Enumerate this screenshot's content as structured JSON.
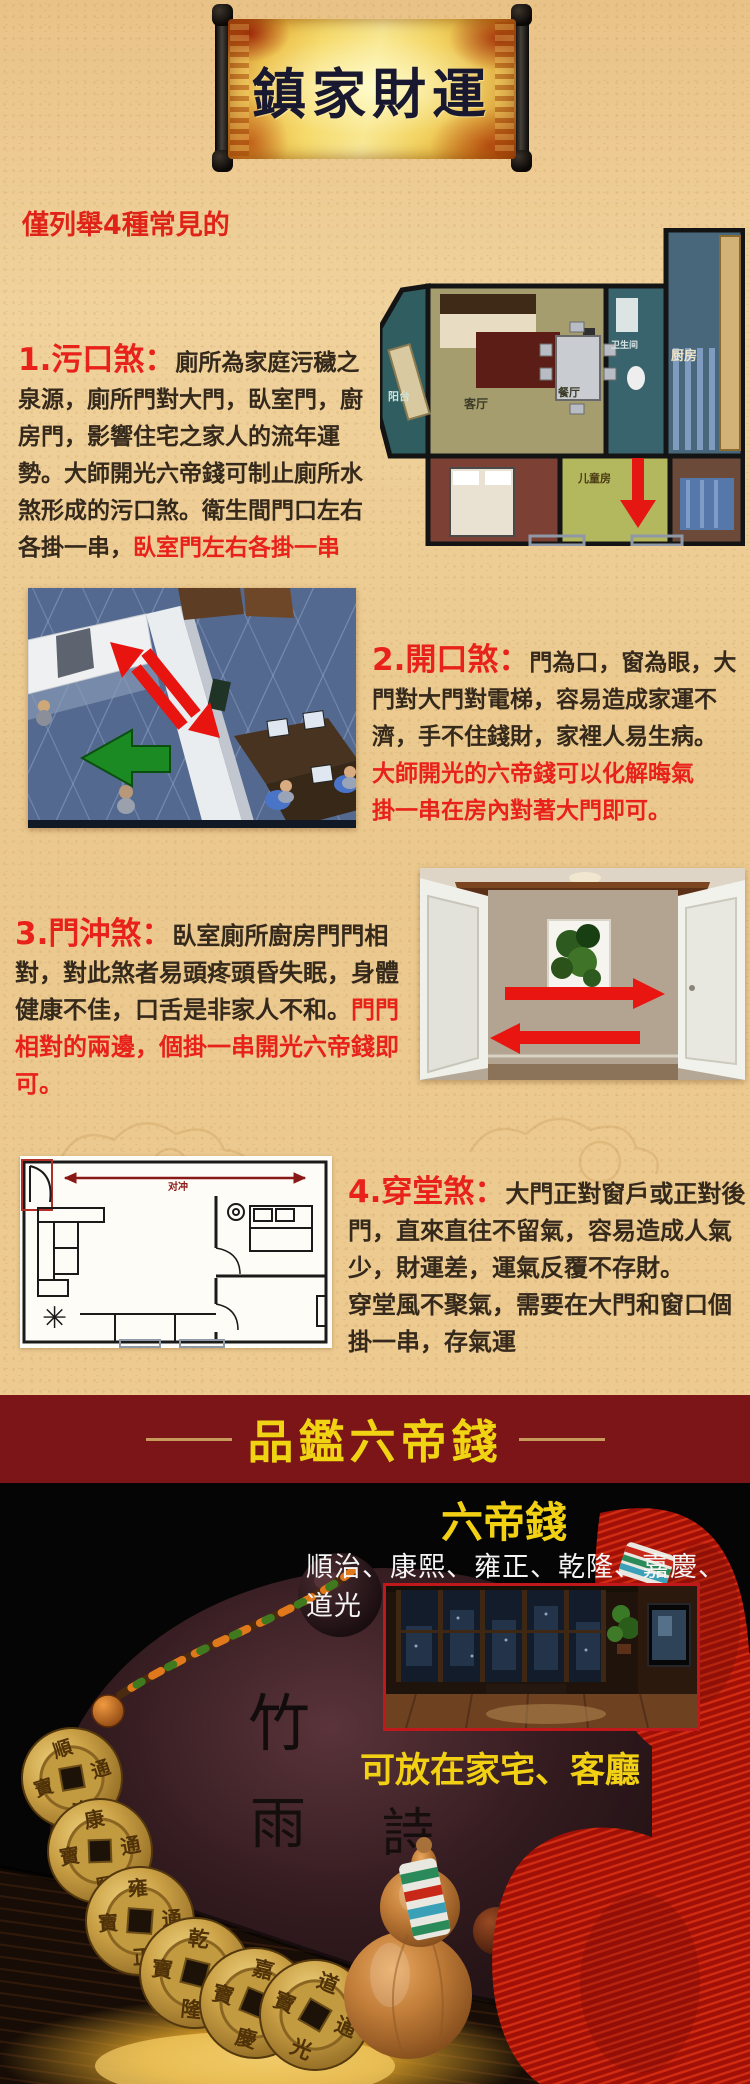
{
  "banner": {
    "title": "鎮家財運"
  },
  "intro": {
    "text": "僅列舉4種常見的"
  },
  "sections": [
    {
      "heading": "1.污口煞：",
      "body": "廁所為家庭污穢之泉源，廁所門對大門，臥室門，廚房門，影響住宅之家人的流年運勢。大師開光六帝錢可制止廁所水煞形成的污口煞。衛生間門口左右各掛一串，",
      "highlight": "臥室門左右各掛一串"
    },
    {
      "heading": "2.開口煞：",
      "body": "門為口，窗為眼，大門對大門對電梯，容易造成家運不濟，手不住錢財，家裡人易生病。",
      "highlight1": "大師開光的六帝錢可以化解晦氣",
      "highlight2": "掛一串在房內對著大門即可。"
    },
    {
      "heading": "3.門沖煞：",
      "body": "臥室廁所廚房門門相對，對此煞者易頭疼頭昏失眠，身體健康不佳，口舌是非家人不和。",
      "highlight": "門門相對的兩邊，個掛一串開光六帝錢即可。"
    },
    {
      "heading": "4.穿堂煞：",
      "body1": "大門正對窗戶或正對後門，直來直往不留氣，容易造成人氣少，財運差，運氣反覆不存財。",
      "body2": "穿堂風不聚氣，需要在大門和窗口個掛一串，存氣運"
    }
  ],
  "floorplan1": {
    "labels": {
      "balcony": "阳台",
      "living": "客厅",
      "dining": "餐厅",
      "kitchen": "厨房",
      "bathroom": "卫生间",
      "kids_room": "儿童房"
    }
  },
  "floorplan2": {
    "arrow_label": "对冲"
  },
  "bottom": {
    "banner_title": "品鑑六帝錢",
    "product_name": "六帝錢",
    "emperors": "順治、康熙、雍正、乾隆、嘉慶、道光",
    "placement": "可放在家宅、客廳"
  },
  "product": {
    "calligraphy": [
      "竹",
      "雨",
      "詩"
    ]
  },
  "coins": [
    {
      "top": "順",
      "bottom": "治",
      "right": "通",
      "left": "寶"
    },
    {
      "top": "康",
      "bottom": "熙",
      "right": "通",
      "left": "寶"
    },
    {
      "top": "雍",
      "bottom": "正",
      "right": "通",
      "left": "寶"
    },
    {
      "top": "乾",
      "bottom": "隆",
      "right": "通",
      "left": "寶"
    },
    {
      "top": "嘉",
      "bottom": "慶",
      "right": "通",
      "left": "寶"
    },
    {
      "top": "道",
      "bottom": "光",
      "right": "通",
      "left": "寶"
    }
  ],
  "colors": {
    "accent_red": "#e8211b",
    "banner_maroon": "#7b1517",
    "highlight_yellow": "#f2d014",
    "parchment": "#ecca90"
  }
}
